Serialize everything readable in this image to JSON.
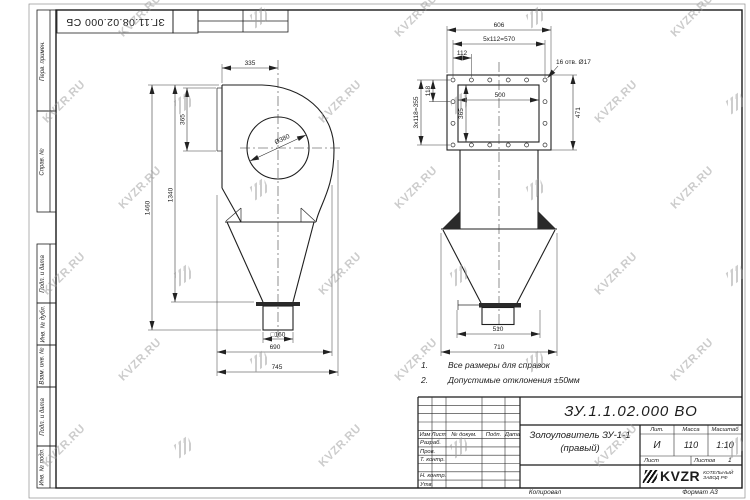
{
  "sheet": {
    "top_stamp_number": "ЗГ.11.08.02.000 СБ",
    "copied_label": "Копировал",
    "format_label": "Формат А3"
  },
  "watermark": {
    "text": "KVZR.RU"
  },
  "sidebar": {
    "labels": [
      "Перв. примен.",
      "Справ. №",
      "Подп. и дата",
      "Инв. № дубл.",
      "Взам. инв. №",
      "Подп. и дата",
      "Инв. № подл."
    ]
  },
  "notes": {
    "items": [
      {
        "num": "1.",
        "text": "Все размеры для справок"
      },
      {
        "num": "2.",
        "text": "Допустимые отклонения ±50мм"
      }
    ]
  },
  "title_block": {
    "doc_number": "ЗУ.1.1.02.000 ВО",
    "name_line1": "Золоуловитель ЗУ-1-1",
    "name_line2": "(правый)",
    "header_cells": [
      "Изм",
      "Лист",
      "№ докум.",
      "Подп.",
      "Дата"
    ],
    "rows": [
      "Разраб.",
      "Пров.",
      "Т. контр.",
      "Н. контр.",
      "Утв."
    ],
    "lit_header": "Лит.",
    "mass_header": "Масса",
    "scale_header": "Масштаб",
    "lit_value": "И",
    "mass_value": "110",
    "scale_value": "1:10",
    "sheet_label": "Лист",
    "sheets_label": "Листов",
    "sheets_value": "1",
    "logo_text": "KVZR",
    "logo_caption_line1": "КОТЕЛЬНЫЙ",
    "logo_caption_line2": "ЗАВОД РФ"
  },
  "views": {
    "left": {
      "dims": {
        "width_335": "335",
        "inlet_365": "365",
        "h_1340": "1340",
        "h_1460": "1460",
        "base_690": "690",
        "overall_745": "745",
        "dia": "Ø380",
        "outlet": "□160"
      }
    },
    "right": {
      "dims": {
        "flange_w": "606",
        "holes_h": "5x112=570",
        "pitch": "112",
        "holes_note": "16 отв. Ø17",
        "pitch_v": "118",
        "holes_v": "3x118=355",
        "inner_h": "365",
        "inner_w": "500",
        "flange_h": "471",
        "outlet_510": "510",
        "base_710": "710"
      }
    }
  },
  "colors": {
    "line": "#1c1c1c",
    "watermark": "#9a9a9a"
  }
}
